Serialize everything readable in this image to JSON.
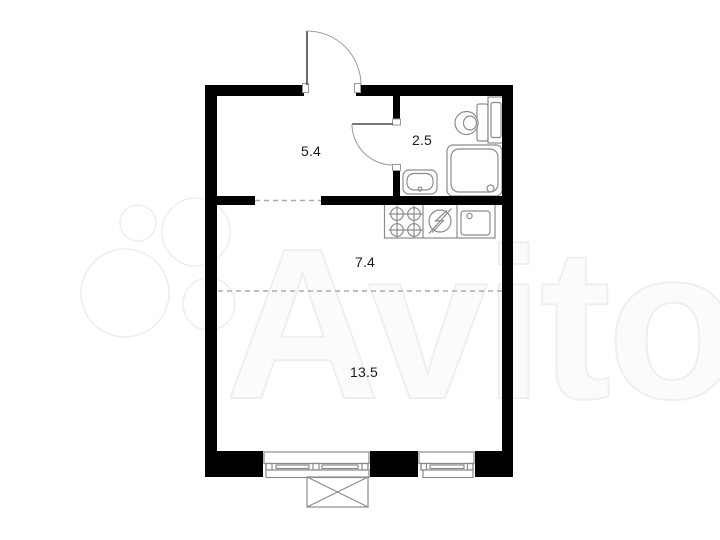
{
  "watermark": {
    "brand": "Avito",
    "logo_icon": "avito-four-circles-icon",
    "text_color": "#fbfbfb",
    "outline_color": "#efefef"
  },
  "plan": {
    "background": "#ffffff",
    "wall_color": "#000000",
    "fixture_stroke": "#8c8c8c",
    "door_leaf_color": "#4a4a4a",
    "door_swing_color": "#9a9a9a",
    "dashed_line_color": "#ababab",
    "label_color": "#1c1c1c"
  },
  "rooms": {
    "hallway": {
      "area": "5.4"
    },
    "bathroom": {
      "area": "2.5"
    },
    "kitchen": {
      "area": "7.4"
    },
    "living": {
      "area": "13.5"
    }
  },
  "fixtures": {
    "bathroom": [
      "toilet-icon",
      "storage-column-icon",
      "shower-tray-icon",
      "washbasin-icon"
    ],
    "kitchen": [
      "cooktop-four-burner-icon",
      "electric-stove-circle-icon",
      "kitchen-sink-icon"
    ],
    "exterior": [
      "window-large",
      "window-small",
      "balcony-box-icon"
    ],
    "doors": [
      "entrance-door",
      "bathroom-door"
    ],
    "openings": [
      "hallway-passage-dashed",
      "zone-divider-dashed"
    ]
  }
}
